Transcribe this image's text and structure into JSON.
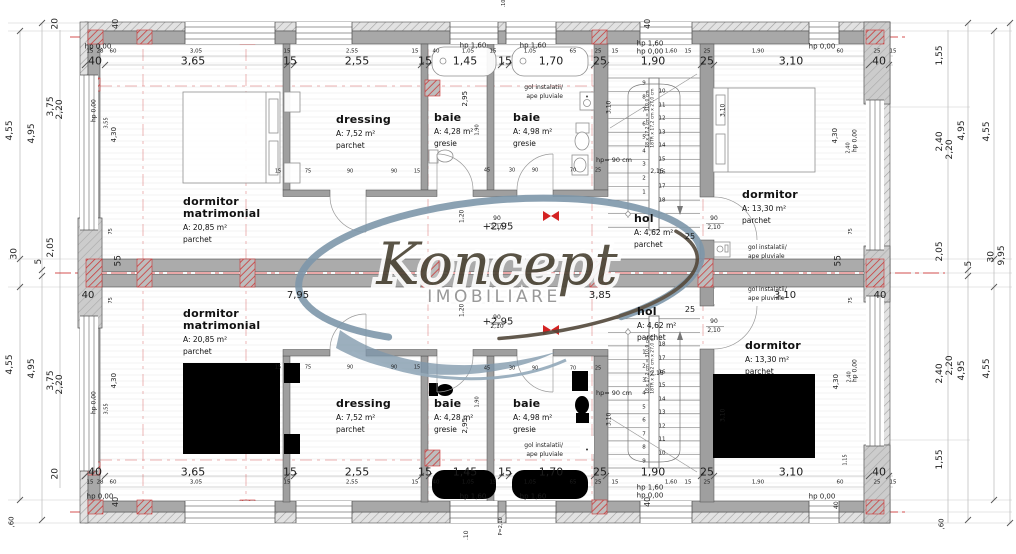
{
  "watermark": {
    "brand": "Koncept",
    "subtitle": "IMOBILIARE"
  },
  "colors": {
    "wall": "#a8a8a8",
    "axis_red": "#cc3434",
    "dim_text": "#1d1d1d",
    "watermark_blue": "#7e97aa",
    "watermark_dark": "#52483a"
  },
  "rooms": [
    {
      "name": "dormitor\nmatrimonial",
      "area": "A: 20,85 m²",
      "finish": "parchet",
      "x": 183,
      "y": 196
    },
    {
      "name": "dormitor\nmatrimonial",
      "area": "A: 20,85 m²",
      "finish": "parchet",
      "x": 183,
      "y": 308
    },
    {
      "name": "dressing",
      "area": "A: 7,52 m²",
      "finish": "parchet",
      "x": 336,
      "y": 114
    },
    {
      "name": "dressing",
      "area": "A: 7,52 m²",
      "finish": "parchet",
      "x": 336,
      "y": 398
    },
    {
      "name": "baie",
      "area": "A: 4,28 m²",
      "finish": "gresie",
      "x": 434,
      "y": 112
    },
    {
      "name": "baie",
      "area": "A: 4,28 m²",
      "finish": "gresie",
      "x": 434,
      "y": 398
    },
    {
      "name": "baie",
      "area": "A: 4,98 m²",
      "finish": "gresie",
      "x": 513,
      "y": 112
    },
    {
      "name": "baie",
      "area": "A: 4,98 m²",
      "finish": "gresie",
      "x": 513,
      "y": 398
    },
    {
      "name": "hol",
      "area": "A: 4,62 m²",
      "finish": "parchet",
      "x": 634,
      "y": 213
    },
    {
      "name": "hol",
      "area": "A: 4,62 m²",
      "finish": "parchet",
      "x": 637,
      "y": 306
    },
    {
      "name": "dormitor",
      "area": "A: 13,30 m²",
      "finish": "parchet",
      "x": 742,
      "y": 189
    },
    {
      "name": "dormitor",
      "area": "A: 13,30 m²",
      "finish": "parchet",
      "x": 745,
      "y": 340
    }
  ],
  "levels": [
    {
      "t": "+2,95",
      "x": 498,
      "y": 227
    },
    {
      "t": "+2,95",
      "x": 498,
      "y": 322
    }
  ],
  "stairs": {
    "left_numbers": [
      "9",
      "8",
      "7",
      "6",
      "5",
      "4",
      "3",
      "2",
      "1"
    ],
    "right_numbers": [
      "10",
      "11",
      "12",
      "13",
      "14",
      "15",
      "16",
      "17",
      "18"
    ],
    "note1": "18 x 17,2 cm = 310,0 cm",
    "note2": "18TR x 17,2 cm x 27,0 cm"
  },
  "labels": [
    {
      "t": "hp 0,00",
      "x": 98,
      "y": 47,
      "s": 7
    },
    {
      "t": "hp 1,60",
      "x": 473,
      "y": 46,
      "s": 7
    },
    {
      "t": "hp 1,60",
      "x": 533,
      "y": 46,
      "s": 7
    },
    {
      "t": "hp 1,60",
      "x": 650,
      "y": 44,
      "s": 7
    },
    {
      "t": "hp 0,00",
      "x": 650,
      "y": 52,
      "s": 7
    },
    {
      "t": "hp 0,00",
      "x": 822,
      "y": 47,
      "s": 7
    },
    {
      "t": "hp 0,00",
      "x": 100,
      "y": 497,
      "s": 7
    },
    {
      "t": "hp 1,60",
      "x": 473,
      "y": 497,
      "s": 7
    },
    {
      "t": "hp 1,60",
      "x": 533,
      "y": 497,
      "s": 7
    },
    {
      "t": "hp 1,60",
      "x": 650,
      "y": 488,
      "s": 7
    },
    {
      "t": "hp 0,00",
      "x": 650,
      "y": 496,
      "s": 7
    },
    {
      "t": "hp 0,00",
      "x": 822,
      "y": 497,
      "s": 7
    },
    {
      "t": "hp 0,00",
      "x": 103,
      "y": 125,
      "s": 6,
      "r": 1
    },
    {
      "t": "hp 0,00",
      "x": 103,
      "y": 417,
      "s": 6,
      "r": 1
    },
    {
      "t": "hp 0,00",
      "x": 864,
      "y": 155,
      "s": 6,
      "r": 1
    },
    {
      "t": "hp 0,00",
      "x": 864,
      "y": 385,
      "s": 6,
      "r": 1
    },
    {
      "t": "hp= 90 cm",
      "x": 614,
      "y": 160,
      "s": 6.5
    },
    {
      "t": "hp= 90 cm",
      "x": 614,
      "y": 393,
      "s": 6.5
    },
    {
      "t": "gol instalatii/",
      "x": 563,
      "y": 88,
      "s": 6,
      "a": "r"
    },
    {
      "t": "ape pluviale",
      "x": 563,
      "y": 97,
      "s": 6,
      "a": "r"
    },
    {
      "t": "gol instalatii/",
      "x": 563,
      "y": 446,
      "s": 6,
      "a": "r"
    },
    {
      "t": "ape pluviale",
      "x": 563,
      "y": 455,
      "s": 6,
      "a": "r"
    },
    {
      "t": "gol instalatii/",
      "x": 748,
      "y": 248,
      "s": 6,
      "a": "l"
    },
    {
      "t": "ape pluviale",
      "x": 748,
      "y": 257,
      "s": 6,
      "a": "l"
    },
    {
      "t": "gol instalatii/",
      "x": 748,
      "y": 290,
      "s": 6,
      "a": "l"
    },
    {
      "t": "ape pluviale",
      "x": 748,
      "y": 299,
      "s": 6,
      "a": "l"
    },
    {
      "t": "7,95",
      "x": 298,
      "y": 296,
      "s": 10
    },
    {
      "t": "3,85",
      "x": 600,
      "y": 296,
      "s": 10
    },
    {
      "t": "3,10",
      "x": 785,
      "y": 296,
      "s": 10
    },
    {
      "t": "40",
      "x": 88,
      "y": 296,
      "s": 10
    },
    {
      "t": "40",
      "x": 880,
      "y": 296,
      "s": 10
    },
    {
      "t": "55",
      "x": 120,
      "y": 271,
      "s": 9,
      "r": 1
    },
    {
      "t": "55",
      "x": 840,
      "y": 271,
      "s": 9,
      "r": 1
    },
    {
      "t": "25",
      "x": 690,
      "y": 237,
      "s": 8
    },
    {
      "t": "25",
      "x": 690,
      "y": 310,
      "s": 8
    },
    {
      "t": "75",
      "x": 852,
      "y": 237,
      "s": 5,
      "r": 1
    },
    {
      "t": "75",
      "x": 852,
      "y": 306,
      "s": 5,
      "r": 1
    },
    {
      "t": "75",
      "x": 112,
      "y": 237,
      "s": 5,
      "r": 1
    },
    {
      "t": "75",
      "x": 112,
      "y": 306,
      "s": 5,
      "r": 1
    },
    {
      "t": "90",
      "x": 497,
      "y": 219,
      "s": 6
    },
    {
      "t": "2,10",
      "x": 497,
      "y": 228,
      "s": 6
    },
    {
      "t": "90",
      "x": 714,
      "y": 219,
      "s": 6
    },
    {
      "t": "2,10",
      "x": 714,
      "y": 228,
      "s": 6
    },
    {
      "t": "90",
      "x": 497,
      "y": 318,
      "s": 6
    },
    {
      "t": "2,10",
      "x": 497,
      "y": 327,
      "s": 6
    },
    {
      "t": "90",
      "x": 714,
      "y": 322,
      "s": 6
    },
    {
      "t": "2,10",
      "x": 714,
      "y": 331,
      "s": 6
    },
    {
      "t": "1,20",
      "x": 466,
      "y": 226,
      "s": 6,
      "r": 1
    },
    {
      "t": "1,20",
      "x": 466,
      "y": 320,
      "s": 6,
      "r": 1
    },
    {
      "t": "2,95",
      "x": 470,
      "y": 110,
      "s": 7,
      "r": 1
    },
    {
      "t": "2,95",
      "x": 470,
      "y": 437,
      "s": 7,
      "r": 1
    },
    {
      "t": "1,90",
      "x": 481,
      "y": 138,
      "s": 5,
      "r": 1
    },
    {
      "t": "1,90",
      "x": 481,
      "y": 410,
      "s": 5,
      "r": 1
    },
    {
      "t": "3,55",
      "x": 110,
      "y": 131,
      "s": 5,
      "r": 1
    },
    {
      "t": "4,30",
      "x": 119,
      "y": 146,
      "s": 7,
      "r": 1
    },
    {
      "t": "3,55",
      "x": 110,
      "y": 417,
      "s": 5,
      "r": 1
    },
    {
      "t": "4,30",
      "x": 119,
      "y": 392,
      "s": 7,
      "r": 1
    },
    {
      "t": "4,30",
      "x": 840,
      "y": 147,
      "s": 7,
      "r": 1
    },
    {
      "t": "2,40",
      "x": 852,
      "y": 156,
      "s": 5,
      "r": 1
    },
    {
      "t": "4,30",
      "x": 841,
      "y": 393,
      "s": 7,
      "r": 1
    },
    {
      "t": "2,40",
      "x": 853,
      "y": 385,
      "s": 5,
      "r": 1
    },
    {
      "t": "1,15",
      "x": 849,
      "y": 468,
      "s": 5,
      "r": 1
    },
    {
      "t": "3,10",
      "x": 613,
      "y": 117,
      "s": 6,
      "r": 1
    },
    {
      "t": "3,10",
      "x": 613,
      "y": 429,
      "s": 6,
      "r": 1
    },
    {
      "t": "3,10",
      "x": 727,
      "y": 120,
      "s": 6,
      "r": 1
    },
    {
      "t": "3,10",
      "x": 727,
      "y": 425,
      "s": 6,
      "r": 1
    },
    {
      "t": "40",
      "x": 117,
      "y": 33,
      "s": 8,
      "r": 1
    },
    {
      "t": "40",
      "x": 649,
      "y": 33,
      "s": 8,
      "r": 1
    },
    {
      "t": "40",
      "x": 117,
      "y": 511,
      "s": 8,
      "r": 1
    },
    {
      "t": "40",
      "x": 649,
      "y": 511,
      "s": 8,
      "r": 1
    },
    {
      "t": "40",
      "x": 838,
      "y": 512,
      "s": 6,
      "r": 1
    },
    {
      "t": ",60",
      "x": 14,
      "y": 531,
      "s": 7,
      "r": 1
    },
    {
      "t": ",60",
      "x": 944,
      "y": 533,
      "s": 7,
      "r": 1
    },
    {
      "t": ".10",
      "x": 469,
      "y": 543,
      "s": 6,
      "r": 1
    },
    {
      "t": "P=2,10",
      "x": 508,
      "y": 538,
      "s": 5,
      "r": 1
    },
    {
      "t": ".10",
      "x": 506,
      "y": 10,
      "s": 5,
      "r": 1
    },
    {
      "t": "2,15",
      "x": 657,
      "y": 172,
      "s": 6
    },
    {
      "t": "2,15",
      "x": 657,
      "y": 374,
      "s": 6
    },
    {
      "t": "15",
      "x": 278,
      "y": 172,
      "s": 5
    },
    {
      "t": "75",
      "x": 308,
      "y": 172,
      "s": 5
    },
    {
      "t": "90",
      "x": 350,
      "y": 172,
      "s": 5
    },
    {
      "t": "90",
      "x": 394,
      "y": 172,
      "s": 5
    },
    {
      "t": "15",
      "x": 417,
      "y": 172,
      "s": 5
    },
    {
      "t": "45",
      "x": 487,
      "y": 171,
      "s": 5
    },
    {
      "t": "30",
      "x": 512,
      "y": 171,
      "s": 5
    },
    {
      "t": "90",
      "x": 535,
      "y": 171,
      "s": 5
    },
    {
      "t": "70",
      "x": 573,
      "y": 171,
      "s": 5
    },
    {
      "t": "25",
      "x": 598,
      "y": 171,
      "s": 5
    },
    {
      "t": "15",
      "x": 278,
      "y": 368,
      "s": 5
    },
    {
      "t": "75",
      "x": 308,
      "y": 368,
      "s": 5
    },
    {
      "t": "90",
      "x": 350,
      "y": 368,
      "s": 5
    },
    {
      "t": "90",
      "x": 394,
      "y": 368,
      "s": 5
    },
    {
      "t": "15",
      "x": 417,
      "y": 368,
      "s": 5
    },
    {
      "t": "45",
      "x": 487,
      "y": 369,
      "s": 5
    },
    {
      "t": "30",
      "x": 512,
      "y": 369,
      "s": 5
    },
    {
      "t": "90",
      "x": 535,
      "y": 369,
      "s": 5
    },
    {
      "t": "70",
      "x": 573,
      "y": 369,
      "s": 5
    },
    {
      "t": "25",
      "x": 598,
      "y": 369,
      "s": 5
    }
  ],
  "dims": {
    "h": [
      {
        "y": 61,
        "s": 11,
        "items": [
          [
            "40",
            95
          ],
          [
            "3,65",
            193
          ],
          [
            "15",
            290
          ],
          [
            "2,55",
            357
          ],
          [
            "15",
            425
          ],
          [
            "1,45",
            465
          ],
          [
            "15",
            505
          ],
          [
            "1,70",
            551
          ],
          [
            "25",
            600
          ],
          [
            "1,90",
            653
          ],
          [
            "25",
            707
          ],
          [
            "3,10",
            791
          ],
          [
            "40",
            879
          ]
        ]
      },
      {
        "y": 52,
        "s": 5.5,
        "items": [
          [
            "15",
            90
          ],
          [
            "28",
            100
          ],
          [
            "60",
            113
          ],
          [
            "3,05",
            196
          ],
          [
            "15",
            287
          ],
          [
            "2,55",
            352
          ],
          [
            "15",
            415
          ],
          [
            "40",
            436
          ],
          [
            "1,05",
            468
          ],
          [
            "15",
            493
          ],
          [
            "1,05",
            530
          ],
          [
            "65",
            573
          ],
          [
            "25",
            598
          ],
          [
            "15",
            615
          ],
          [
            "1,60",
            671
          ],
          [
            "15",
            688
          ],
          [
            "25",
            707
          ],
          [
            "1,90",
            758
          ],
          [
            "60",
            840
          ],
          [
            "25",
            877
          ],
          [
            "15",
            893
          ]
        ]
      },
      {
        "y": 472,
        "s": 11,
        "items": [
          [
            "40",
            95
          ],
          [
            "3,65",
            193
          ],
          [
            "15",
            290
          ],
          [
            "2,55",
            357
          ],
          [
            "15",
            425
          ],
          [
            "1,45",
            465
          ],
          [
            "15",
            505
          ],
          [
            "1,70",
            551
          ],
          [
            "25",
            600
          ],
          [
            "1,90",
            653
          ],
          [
            "25",
            707
          ],
          [
            "3,10",
            791
          ],
          [
            "40",
            879
          ]
        ]
      },
      {
        "y": 483,
        "s": 5.5,
        "items": [
          [
            "15",
            90
          ],
          [
            "28",
            100
          ],
          [
            "60",
            113
          ],
          [
            "3,05",
            196
          ],
          [
            "15",
            287
          ],
          [
            "2,55",
            352
          ],
          [
            "15",
            415
          ],
          [
            "40",
            436
          ],
          [
            "1,05",
            468
          ],
          [
            "15",
            493
          ],
          [
            "1,05",
            530
          ],
          [
            "65",
            573
          ],
          [
            "25",
            598
          ],
          [
            "15",
            615
          ],
          [
            "1,60",
            671
          ],
          [
            "15",
            688
          ],
          [
            "25",
            707
          ],
          [
            "1,90",
            758
          ],
          [
            "60",
            840
          ],
          [
            "25",
            877
          ],
          [
            "15",
            893
          ]
        ]
      }
    ],
    "v": [
      {
        "x": 16,
        "s": 9,
        "items": [
          [
            "4,55",
            145
          ],
          [
            "30",
            264
          ],
          [
            "4,55",
            379
          ]
        ]
      },
      {
        "x": 38,
        "s": 9,
        "items": [
          [
            "4,95",
            148
          ],
          [
            "5",
            269
          ],
          [
            "4,95",
            383
          ]
        ]
      },
      {
        "x": 57,
        "s": 9,
        "items": [
          [
            "20",
            34
          ],
          [
            "3,75",
            121
          ],
          [
            "2,05",
            262
          ],
          [
            "3,75",
            395
          ],
          [
            "20",
            484
          ]
        ]
      },
      {
        "x": 66,
        "s": 9,
        "items": [
          [
            "2,20",
            124
          ],
          [
            "2,20",
            399
          ]
        ]
      },
      {
        "x": 946,
        "s": 9,
        "items": [
          [
            "1,55",
            70
          ],
          [
            "2,40",
            156
          ],
          [
            "2,05",
            266
          ],
          [
            "2,40",
            388
          ],
          [
            "1,55",
            474
          ]
        ]
      },
      {
        "x": 956,
        "s": 9,
        "items": [
          [
            "2,20",
            164
          ],
          [
            "2,20",
            380
          ]
        ]
      },
      {
        "x": 968,
        "s": 9,
        "items": [
          [
            "4,95",
            145
          ],
          [
            "5",
            271
          ],
          [
            "4,95",
            385
          ]
        ]
      },
      {
        "x": 993,
        "s": 9,
        "items": [
          [
            "4,55",
            146
          ],
          [
            "30",
            267
          ],
          [
            "4,55",
            383
          ]
        ]
      },
      {
        "x": 1008,
        "s": 9,
        "items": [
          [
            "9,95",
            270
          ]
        ]
      }
    ]
  }
}
